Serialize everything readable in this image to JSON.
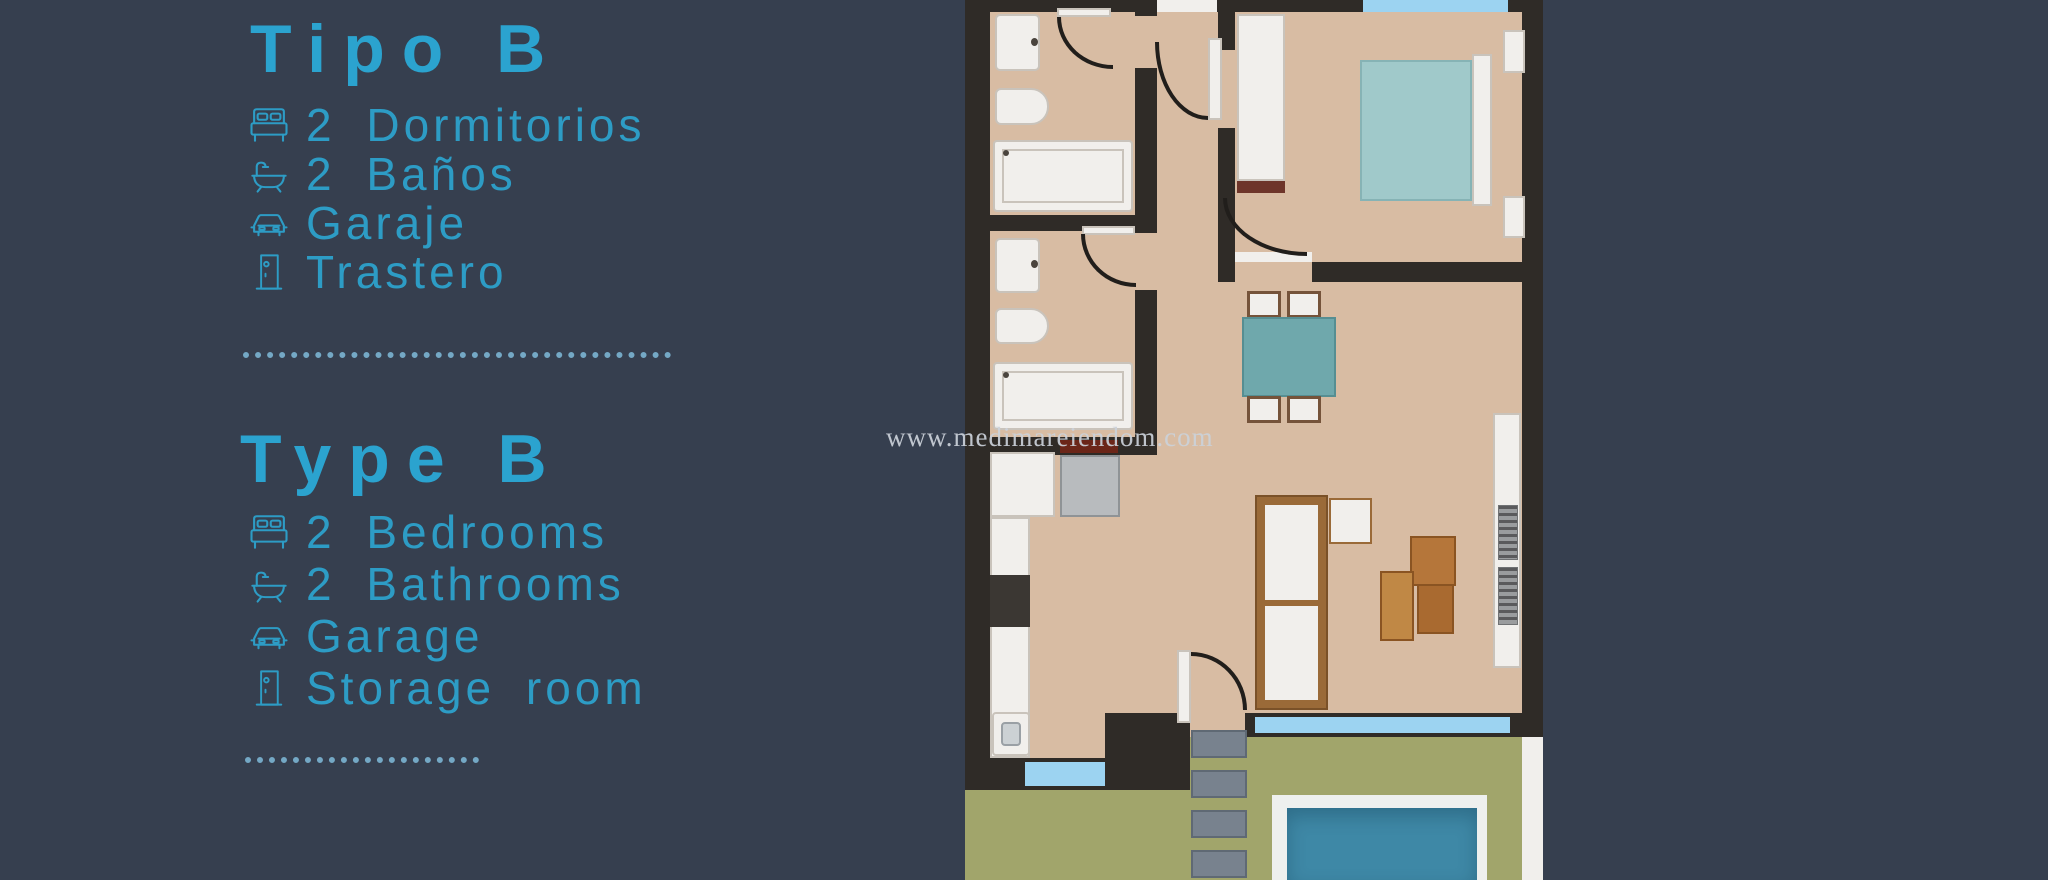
{
  "panel": {
    "title_es": "Tipo B",
    "features_es": [
      {
        "icon": "bed-icon",
        "label": "2 Dormitorios"
      },
      {
        "icon": "bath-icon",
        "label": "2 Baños"
      },
      {
        "icon": "car-icon",
        "label": "Garaje"
      },
      {
        "icon": "door-icon",
        "label": "Trastero"
      }
    ],
    "title_en": "Type B",
    "features_en": [
      {
        "icon": "bed-icon",
        "label": "2 Bedrooms"
      },
      {
        "icon": "bath-icon",
        "label": "2 Bathrooms"
      },
      {
        "icon": "car-icon",
        "label": "Garage"
      },
      {
        "icon": "door-icon",
        "label": "Storage room"
      }
    ]
  },
  "watermark": "www.medimareiendom.com",
  "floorplan": {
    "rooms": [
      "bathroom-1",
      "bathroom-2",
      "hallway",
      "bedroom",
      "dining-area",
      "kitchen",
      "living-room",
      "terrace",
      "pool"
    ]
  },
  "palette": {
    "bg": "#363f4f",
    "accent": "#2ba3cf",
    "accent2": "#2d9cc5",
    "dots": "#74a8c5",
    "floor": "#d8bca3",
    "wall": "#2f2b27",
    "white": "#f1efec",
    "line": "#c9c3bb",
    "bed-teal": "#a0c9ca",
    "table-teal": "#6fa8ac",
    "wood": "#b5763a",
    "wood-dark": "#8a5422",
    "wood-base": "#6e352a",
    "chair-wood": "#75533a",
    "sofa-wood": "#9a6a38",
    "light-blue": "#9cd3f1",
    "green": "#a1a56b",
    "pool": "#3e88a6",
    "pool-deck": "#eef0ee",
    "step": "#78828e",
    "appliance": "#b8bbbe",
    "cooktop": "#3b3733",
    "knob": "#b5472c",
    "red-shelf": "#6b2619",
    "arc": "#211e1b",
    "watermark": "#ccd2da"
  }
}
